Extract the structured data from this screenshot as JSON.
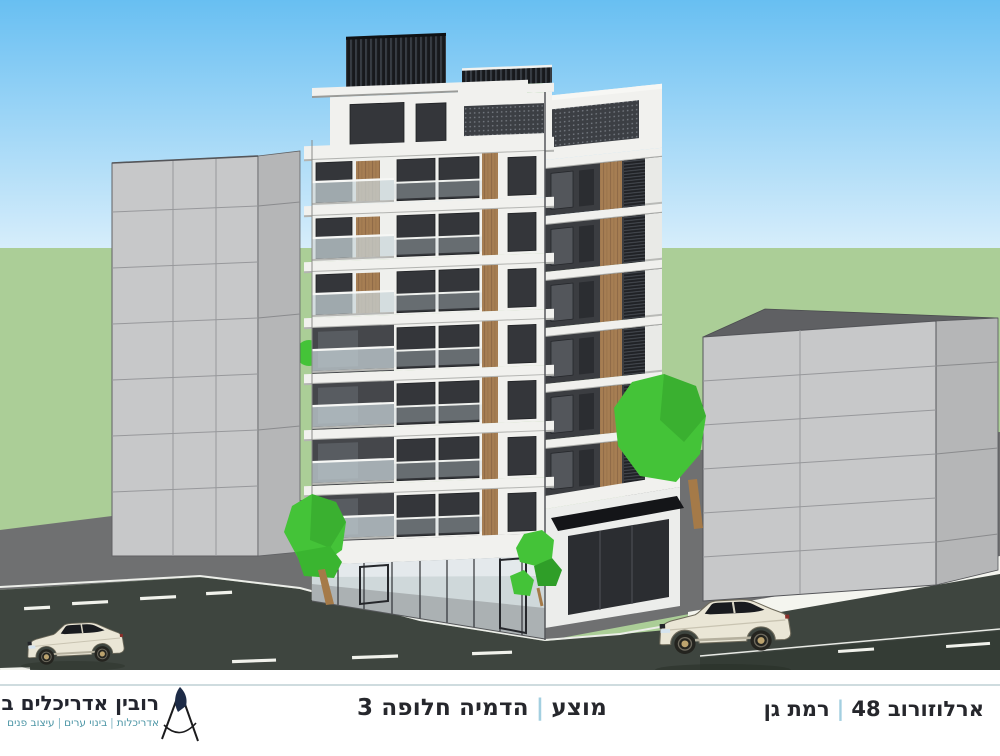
{
  "palette": {
    "sky-top": "#68bff2",
    "sky-horizon": "#d8eefb",
    "grass": "#abce97",
    "sidewalk": "#6f7071",
    "road": "#3e453f",
    "road-dark": "#343c35",
    "curb": "#f4f5ef",
    "lane": "#f1f2ec",
    "bldg-white": "#f1f1ee",
    "glass": "#34363a",
    "wood": "#a67e53",
    "charcoal": "#3b3d41",
    "screen": "#24262a",
    "balustrade": "#c9d5d9",
    "neighbor-front": "#c7c8c9",
    "neighbor-side": "#b5b6b7",
    "neighbor-roof": "#5f6063",
    "tree": "#44c338",
    "tree-dark": "#2f9e28",
    "trunk": "#a57a48",
    "car": "#eae6d6",
    "ink": "#26272c",
    "teal": "#4d96a6",
    "separator": "#a3cfe0",
    "divider": "#cfdcdf",
    "logo-ink": "#23252e",
    "logo-navy": "#1d2b47"
  },
  "scene": {
    "description": "3D architectural massing rendering: proposed residential corner tower with wood accents, glass balconies and ground-floor storefront, flanked by plain grey neighbour blocks, street with two cream coupes, low-poly green trees",
    "elements": [
      "sky",
      "lawn",
      "left-neighbor-building",
      "right-neighbor-building",
      "proposed-tower",
      "rooftop-pergola",
      "storefront",
      "entrance-canopy",
      "sidewalk",
      "crosswalk-band",
      "road",
      "lane-markings",
      "trees",
      "car-left",
      "car-right"
    ]
  },
  "footer": {
    "right": {
      "street": "ארלוזורוב 48",
      "separator": "|",
      "city": "רמת גן"
    },
    "center": {
      "status": "מוצע",
      "separator": "|",
      "caption": "הדמיה חלופה 3"
    },
    "left": {
      "company": "רובין אדריכלים בע״מ",
      "tagline_parts": [
        "אדריכלות",
        "בינוי ערים",
        "עיצוב פנים"
      ],
      "tagline_separator": "|",
      "logo": "compass-icon"
    }
  }
}
